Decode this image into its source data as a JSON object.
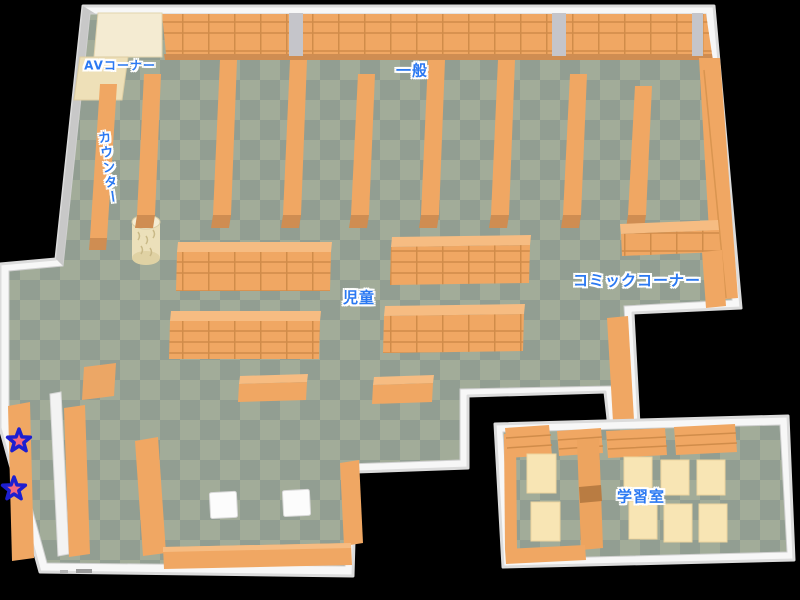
{
  "map": {
    "name": "library-floor-map",
    "areas": [
      {
        "id": "av-corner",
        "label": "AVコーナー"
      },
      {
        "id": "counter",
        "label": "カウンター"
      },
      {
        "id": "general",
        "label": "一般"
      },
      {
        "id": "children",
        "label": "児童"
      },
      {
        "id": "comic-corner",
        "label": "コミックコーナー"
      },
      {
        "id": "study-room",
        "label": "学習室"
      }
    ],
    "markers": [
      {
        "id": "star-1",
        "shape": "star"
      },
      {
        "id": "star-2",
        "shape": "star"
      }
    ],
    "colors": {
      "background": "#000000",
      "wall_white": "#f7f7f7",
      "wall_shadow": "#c8c8c8",
      "floor_light": "#a2ac99",
      "floor_dark": "#929e92",
      "shelf_orange": "#f0a763",
      "shelf_orange_top": "#f6bc82",
      "shelf_orange_dark": "#cf8d52",
      "shelf_line": "#d08c4a",
      "av_cream": "#f4ebd2",
      "desk_cream": "#f8e5b4",
      "label_blue": "#2b79f2",
      "label_outline": "#ffffff",
      "star_pink": "#f4697e",
      "star_outline": "#1d1fd0"
    }
  }
}
